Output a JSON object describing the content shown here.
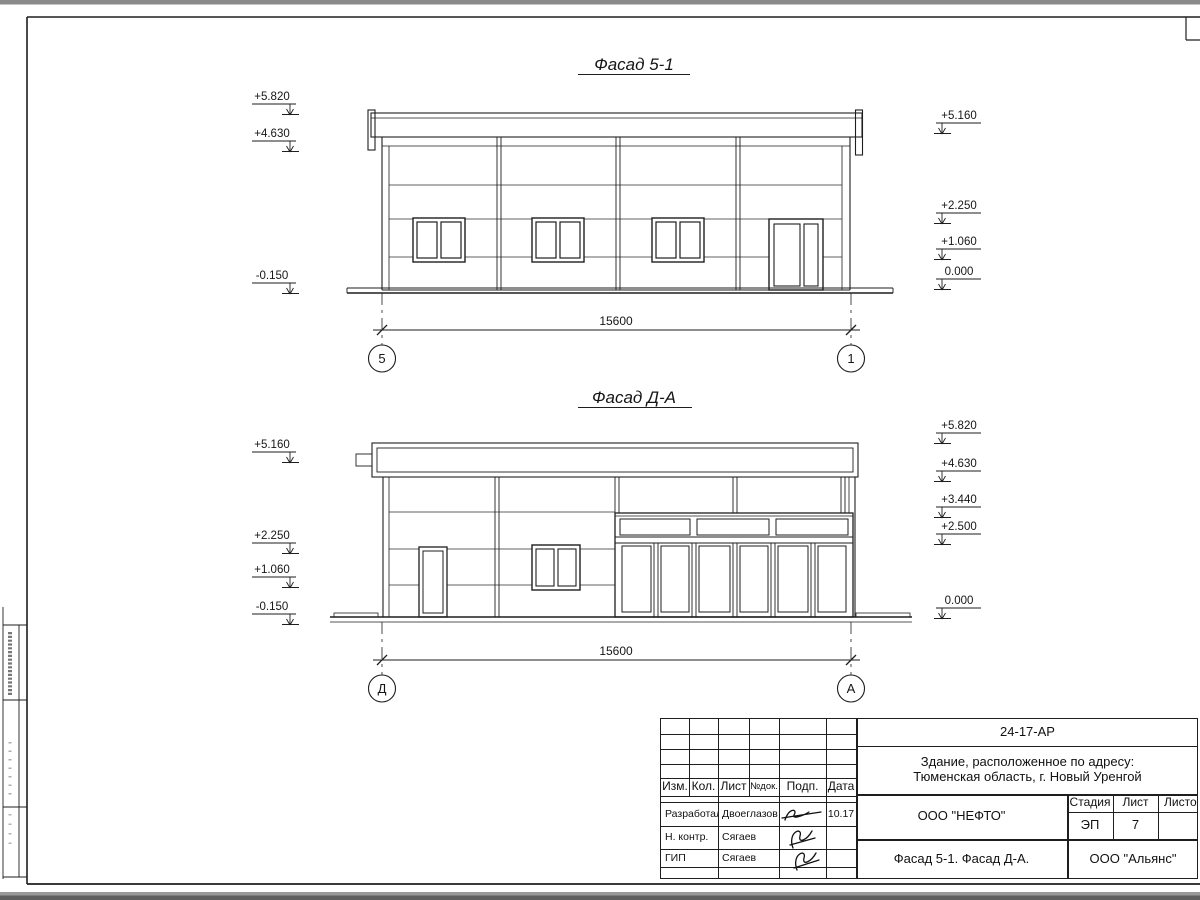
{
  "sheet": {
    "facade1": {
      "title": "Фасад 5-1",
      "dimension": "15600",
      "axis_left": "5",
      "axis_right": "1",
      "marks_left": [
        "+5.820",
        "+4.630",
        "-0.150"
      ],
      "marks_right": [
        "+5.160",
        "+2.250",
        "+1.060",
        "0.000"
      ]
    },
    "facade2": {
      "title": "Фасад Д-А",
      "dimension": "15600",
      "axis_left": "Д",
      "axis_right": "А",
      "marks_left": [
        "+5.160",
        "+2.250",
        "+1.060",
        "-0.150"
      ],
      "marks_right": [
        "+5.820",
        "+4.630",
        "+3.440",
        "+2.500",
        "0.000"
      ]
    },
    "titleblock": {
      "doc_number": "24-17-АР",
      "address_line1": "Здание, расположенное по адресу:",
      "address_line2": "Тюменская область, г. Новый Уренгой",
      "columns": {
        "izm": "Изм.",
        "kol": "Кол.",
        "list": "Лист",
        "ndok": "№док.",
        "podp": "Подп.",
        "data": "Дата"
      },
      "rows": [
        {
          "role": "Разработал",
          "name": "Двоеглазов",
          "date": "10.17"
        },
        {
          "role": "Н. контр.",
          "name": "Сягаев",
          "date": ""
        },
        {
          "role": "ГИП",
          "name": "Сягаев",
          "date": ""
        }
      ],
      "designer": "ООО \"НЕФТО\"",
      "stage_label": "Стадия",
      "stage_value": "ЭП",
      "sheet_label": "Лист",
      "sheet_value": "7",
      "sheets_label": "Листов",
      "drawing_title": "Фасад 5-1. Фасад Д-А.",
      "contractor": "ООО \"Альянс\""
    },
    "colors": {
      "ink": "#1e1e1e",
      "paper": "#ffffff",
      "scan_edge": "#8a8a8a"
    }
  }
}
